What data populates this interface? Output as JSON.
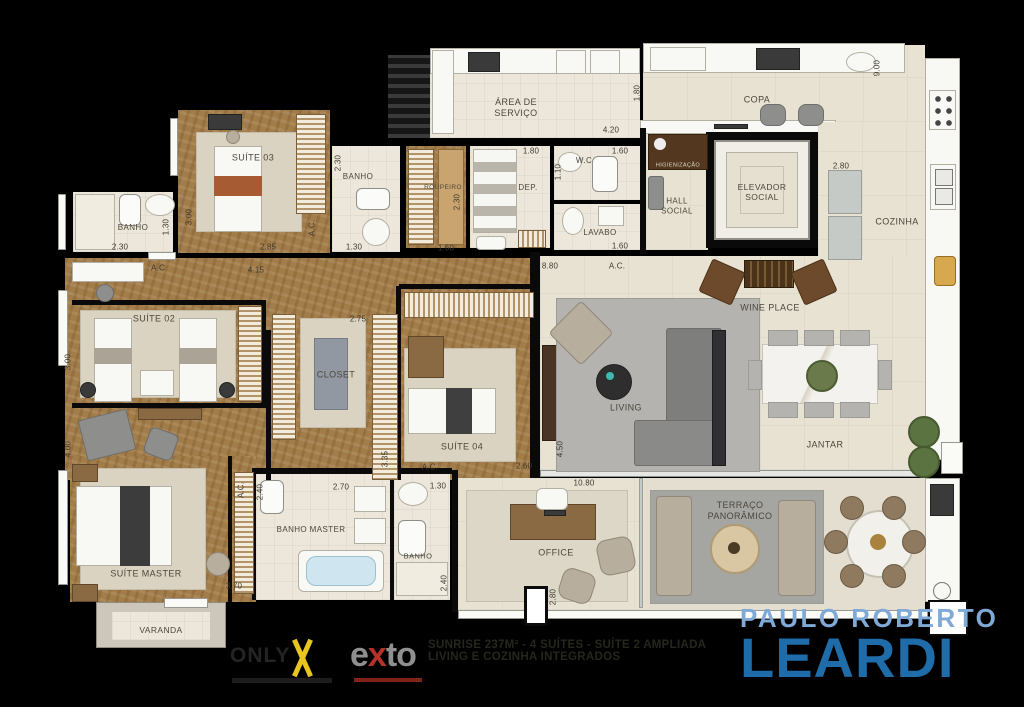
{
  "rooms": {
    "area_servico": {
      "label": "ÁREA DE\nSERVIÇO"
    },
    "copa": {
      "label": "COPA"
    },
    "cozinha": {
      "label": "COZINHA"
    },
    "hall_social": {
      "label": "HALL\nSOCIAL"
    },
    "higienizacao": {
      "label": "HIGIENIZAÇÃO"
    },
    "elevador": {
      "label": "ELEVADOR\nSOCIAL"
    },
    "suite03": {
      "label": "SUÍTE 03"
    },
    "banho_suite03": {
      "label": "BANHO"
    },
    "banho_suite02": {
      "label": "BANHO"
    },
    "roupeiro": {
      "label": "ROUPEIRO"
    },
    "dep": {
      "label": "DEP."
    },
    "wc": {
      "label": "W.C"
    },
    "lavabo": {
      "label": "LAVABO"
    },
    "suite02": {
      "label": "SUÍTE 02"
    },
    "closet": {
      "label": "CLOSET"
    },
    "suite04": {
      "label": "SUÍTE 04"
    },
    "living": {
      "label": "LIVING"
    },
    "wine_place": {
      "label": "WINE PLACE"
    },
    "jantar": {
      "label": "JANTAR"
    },
    "suite_master": {
      "label": "SUÍTE MASTER"
    },
    "banho_master": {
      "label": "BANHO MASTER"
    },
    "banho_suite04": {
      "label": "BANHO"
    },
    "office": {
      "label": "OFFICE"
    },
    "terraco": {
      "label": "TERRAÇO\nPANORÂMICO"
    },
    "varanda": {
      "label": "VARANDA"
    }
  },
  "dimensions": [
    {
      "t": "2.30",
      "x": 120,
      "y": 247,
      "v": false
    },
    {
      "t": "1.30",
      "x": 166,
      "y": 227,
      "v": true
    },
    {
      "t": "3.00",
      "x": 189,
      "y": 217,
      "v": true
    },
    {
      "t": "2.85",
      "x": 268,
      "y": 247,
      "v": false
    },
    {
      "t": "A.C.",
      "x": 312,
      "y": 228,
      "v": true
    },
    {
      "t": "2.30",
      "x": 338,
      "y": 163,
      "v": true
    },
    {
      "t": "1.30",
      "x": 354,
      "y": 247,
      "v": false
    },
    {
      "t": "2.30",
      "x": 457,
      "y": 202,
      "v": true
    },
    {
      "t": "1.60",
      "x": 446,
      "y": 248,
      "v": false
    },
    {
      "t": "1.80",
      "x": 531,
      "y": 151,
      "v": false
    },
    {
      "t": "1.60",
      "x": 620,
      "y": 151,
      "v": false
    },
    {
      "t": "1.10",
      "x": 558,
      "y": 172,
      "v": true
    },
    {
      "t": "1.60",
      "x": 620,
      "y": 246,
      "v": false
    },
    {
      "t": "4.20",
      "x": 611,
      "y": 130,
      "v": false
    },
    {
      "t": "1.80",
      "x": 637,
      "y": 93,
      "v": true
    },
    {
      "t": "9.00",
      "x": 877,
      "y": 68,
      "v": true
    },
    {
      "t": "2.80",
      "x": 841,
      "y": 166,
      "v": false
    },
    {
      "t": "4.15",
      "x": 256,
      "y": 270,
      "v": false
    },
    {
      "t": "A.C",
      "x": 158,
      "y": 268,
      "v": false
    },
    {
      "t": "3.00",
      "x": 68,
      "y": 362,
      "v": true
    },
    {
      "t": "2.75",
      "x": 358,
      "y": 319,
      "v": false
    },
    {
      "t": "8.80",
      "x": 550,
      "y": 266,
      "v": false
    },
    {
      "t": "A.C.",
      "x": 617,
      "y": 266,
      "v": false
    },
    {
      "t": "4.50",
      "x": 560,
      "y": 449,
      "v": true
    },
    {
      "t": "10.80",
      "x": 584,
      "y": 483,
      "v": false
    },
    {
      "t": "2.60",
      "x": 524,
      "y": 466,
      "v": false
    },
    {
      "t": "A.C.",
      "x": 430,
      "y": 467,
      "v": false
    },
    {
      "t": "3.35",
      "x": 385,
      "y": 459,
      "v": true
    },
    {
      "t": "1.30",
      "x": 438,
      "y": 486,
      "v": false
    },
    {
      "t": "2.40",
      "x": 444,
      "y": 583,
      "v": true
    },
    {
      "t": "2.70",
      "x": 341,
      "y": 487,
      "v": false
    },
    {
      "t": "2.40",
      "x": 260,
      "y": 492,
      "v": true
    },
    {
      "t": "3.70",
      "x": 234,
      "y": 586,
      "v": false
    },
    {
      "t": "A.C.",
      "x": 241,
      "y": 490,
      "v": true
    },
    {
      "t": "4.00",
      "x": 68,
      "y": 449,
      "v": true
    },
    {
      "t": "2.80",
      "x": 553,
      "y": 597,
      "v": true
    }
  ],
  "branding": {
    "only_label": "ONLY",
    "exto_e": "e",
    "exto_x": "x",
    "exto_t": "t",
    "exto_o": "o",
    "tagline_line1": "SUNRISE 237M² - 4 SUÍTES - SUÍTE 2 AMPLIADA",
    "tagline_line2": "LIVING E COZINHA INTEGRADOS",
    "realtor_top": "PAULO ROBERTO",
    "realtor_main": "LEARDI"
  },
  "colors": {
    "background": "#000000",
    "wood_floor": "#a27c49",
    "light_floor": "#e8e2d3",
    "realtor_blue": "#1f6cab",
    "realtor_light_blue": "#7fa9d6",
    "only_yellow": "#e9c51f",
    "exto_red": "#b63226"
  }
}
